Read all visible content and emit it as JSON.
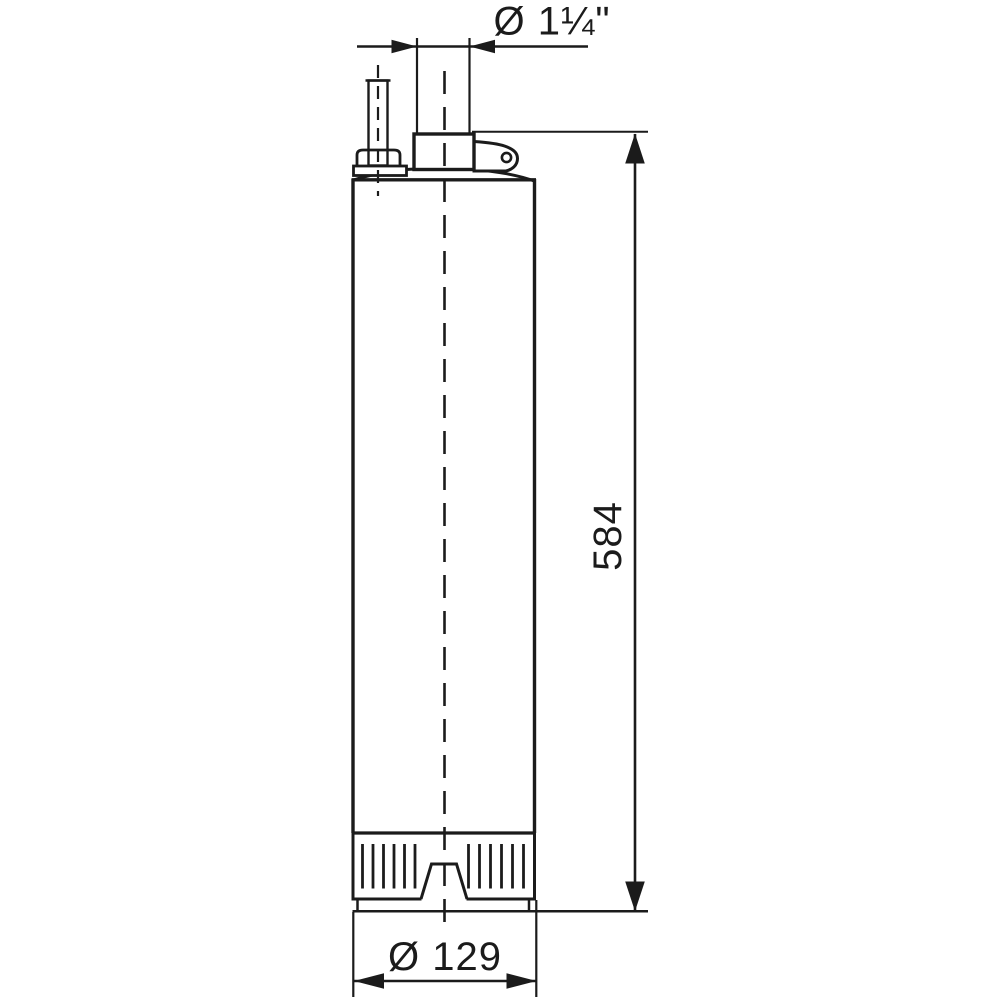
{
  "page": {
    "background": "#ffffff",
    "line_color": "#1b1b1b"
  },
  "drawing": {
    "labels": {
      "outlet_diameter": "Ø 1¼\"",
      "overall_height": "584",
      "body_diameter": "Ø 129"
    }
  }
}
